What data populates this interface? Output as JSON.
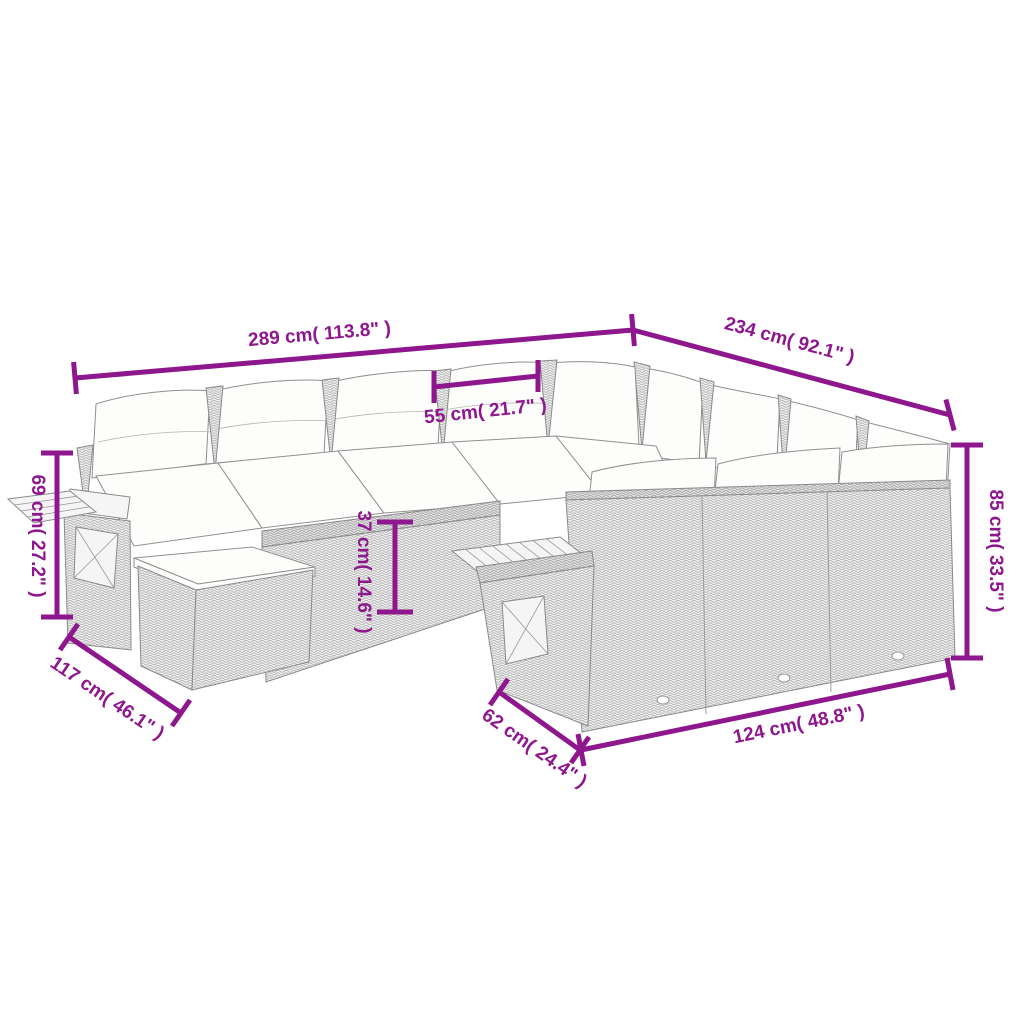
{
  "diagram": {
    "product_name": "modular-garden-lounge-set-with-cushions",
    "dimensions": {
      "overall_width": "289 cm( 113.8\" )",
      "overall_depth": "234 cm( 92.1\" )",
      "seat_width": "55 cm( 21.7\" )",
      "armrest_height": "69 cm( 27.2\" )",
      "seat_height": "37 cm( 14.6\" )",
      "back_height": "85 cm( 33.5\" )",
      "left_section_depth": "117 cm( 46.1\" )",
      "side_depth": "62 cm( 24.4\" )",
      "front_sofa_width": "124 cm( 48.8\" )"
    },
    "colors": {
      "dimension_accent": "#8e178e",
      "line_art": "#8a8a8a",
      "weave_fill": "#ececec",
      "cushion_fill": "#fdfdfc",
      "background": "#ffffff"
    }
  }
}
